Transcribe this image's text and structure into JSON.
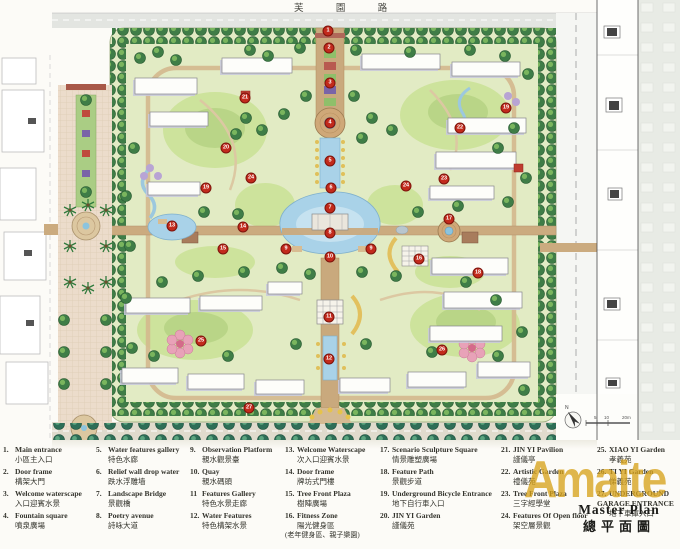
{
  "map": {
    "top_road_label": "芙 園 路",
    "north_label": "N",
    "scale_labels": [
      "5",
      "10",
      "20m"
    ],
    "markers": [
      {
        "n": "1",
        "x": 328,
        "y": 31
      },
      {
        "n": "2",
        "x": 329,
        "y": 48
      },
      {
        "n": "3",
        "x": 330,
        "y": 83
      },
      {
        "n": "4",
        "x": 330,
        "y": 123
      },
      {
        "n": "5",
        "x": 330,
        "y": 161
      },
      {
        "n": "6",
        "x": 331,
        "y": 188
      },
      {
        "n": "7",
        "x": 330,
        "y": 208
      },
      {
        "n": "8",
        "x": 330,
        "y": 233
      },
      {
        "n": "9",
        "x": 286,
        "y": 249
      },
      {
        "n": "9",
        "x": 371,
        "y": 249
      },
      {
        "n": "10",
        "x": 330,
        "y": 257
      },
      {
        "n": "11",
        "x": 329,
        "y": 317
      },
      {
        "n": "12",
        "x": 329,
        "y": 359
      },
      {
        "n": "13",
        "x": 172,
        "y": 226
      },
      {
        "n": "14",
        "x": 243,
        "y": 227
      },
      {
        "n": "15",
        "x": 223,
        "y": 249
      },
      {
        "n": "16",
        "x": 419,
        "y": 259
      },
      {
        "n": "17",
        "x": 449,
        "y": 219
      },
      {
        "n": "18",
        "x": 478,
        "y": 273
      },
      {
        "n": "19",
        "x": 206,
        "y": 188
      },
      {
        "n": "19",
        "x": 506,
        "y": 108
      },
      {
        "n": "20",
        "x": 226,
        "y": 148
      },
      {
        "n": "21",
        "x": 245,
        "y": 98
      },
      {
        "n": "22",
        "x": 460,
        "y": 128
      },
      {
        "n": "23",
        "x": 444,
        "y": 179
      },
      {
        "n": "24",
        "x": 251,
        "y": 178
      },
      {
        "n": "24",
        "x": 406,
        "y": 186
      },
      {
        "n": "25",
        "x": 201,
        "y": 341
      },
      {
        "n": "26",
        "x": 442,
        "y": 350
      },
      {
        "n": "27",
        "x": 249,
        "y": 408
      }
    ]
  },
  "legend": {
    "columns": [
      [
        {
          "num": "1.",
          "en": "Main entrance",
          "zh": "小區主入口"
        },
        {
          "num": "2.",
          "en": "Door frame",
          "zh": "構架大門"
        },
        {
          "num": "3.",
          "en": "Welcome waterscape",
          "zh": "入口迎賓水景"
        },
        {
          "num": "4.",
          "en": "Fountain square",
          "zh": "噴泉廣場"
        }
      ],
      [
        {
          "num": "5.",
          "en": "Water features gallery",
          "zh": "特色水廊"
        },
        {
          "num": "6.",
          "en": "Relief wall drop water",
          "zh": "跌水浮雕墙"
        },
        {
          "num": "7.",
          "en": "Landscape Bridge",
          "zh": "景觀橋"
        },
        {
          "num": "8.",
          "en": "Poetry avenue",
          "zh": "詩咏大道"
        }
      ],
      [
        {
          "num": "9.",
          "en": "Observation Platform",
          "zh": "親水觀景臺"
        },
        {
          "num": "10.",
          "en": "Quay",
          "zh": "親水碼頭"
        },
        {
          "num": "11",
          "en": "Features Gallery",
          "zh": "特色水景走廊"
        },
        {
          "num": "12.",
          "en": "Water Features",
          "zh": "特色構架水景"
        }
      ],
      [
        {
          "num": "13.",
          "en": "Welcome Waterscape",
          "zh": "次入口迎賓水景"
        },
        {
          "num": "14.",
          "en": "Door frame",
          "zh": "牌坊式門樓"
        },
        {
          "num": "15.",
          "en": "Tree Front Plaza",
          "zh": "樹陣廣場"
        },
        {
          "num": "16.",
          "en": "Fitness Zone",
          "zh": "陽光健身區",
          "extra": "(老年健身區、親子樂園)"
        }
      ],
      [
        {
          "num": "17.",
          "en": "Scenario Sculpture Square",
          "zh": "情景雕塑廣場"
        },
        {
          "num": "18.",
          "en": "Feature Path",
          "zh": "景觀步道"
        },
        {
          "num": "19.",
          "en": "Underground Bicycle Entrance",
          "zh": "地下自行車入口"
        },
        {
          "num": "20.",
          "en": "JIN YI Garden",
          "zh": "謹儀苑"
        }
      ],
      [
        {
          "num": "21.",
          "en": "JIN YI Pavilion",
          "zh": "謹儀亭"
        },
        {
          "num": "22.",
          "en": "Artistic Garden",
          "zh": "禮儀苑"
        },
        {
          "num": "23.",
          "en": "Tree Front Plaza",
          "zh": "三字經學堂"
        },
        {
          "num": "24.",
          "en": "Features Of Open floor",
          "zh": "架空層景觀"
        }
      ],
      [
        {
          "num": "25.",
          "en": "XIAO YI Garden",
          "zh": "孝義苑"
        },
        {
          "num": "26.",
          "en": "TI YI Garden",
          "zh": "悌義苑"
        },
        {
          "num": "27.",
          "en": "UNDERGROUND GARAGE ENTRANCE",
          "zh": "地下車庫入口"
        }
      ]
    ]
  },
  "titleblock": {
    "title_en": "Master Plan",
    "title_zh": "總平面圖"
  },
  "watermark": {
    "text": "Amaite"
  }
}
